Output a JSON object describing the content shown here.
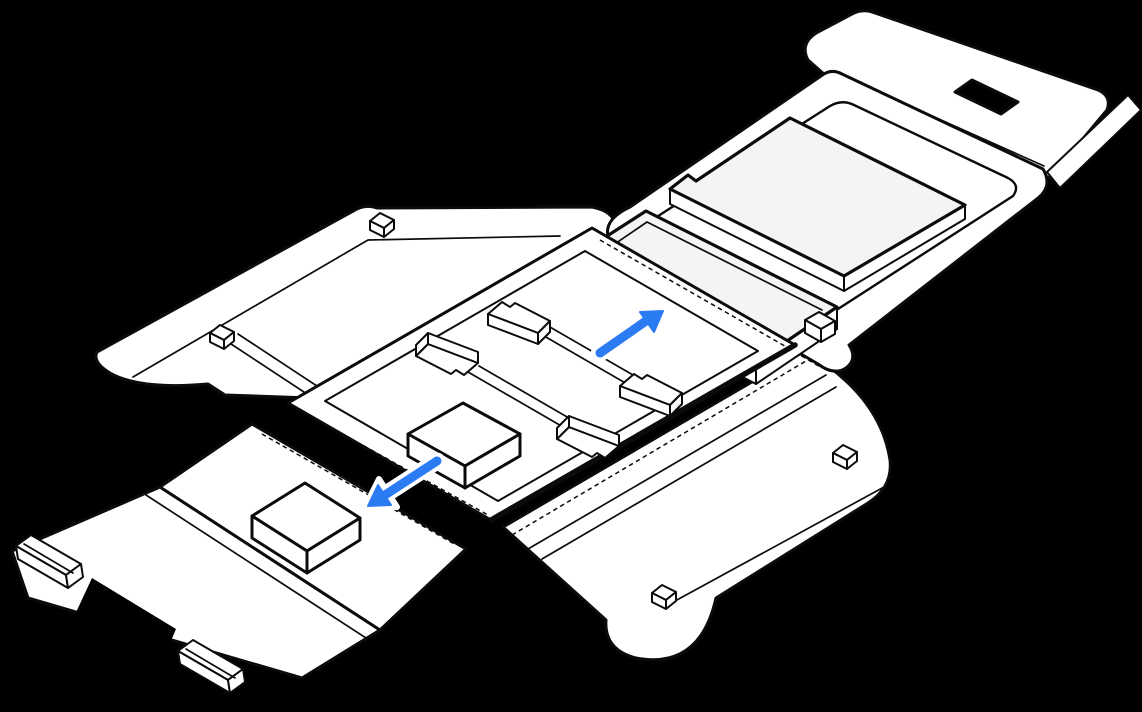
{
  "illustration": {
    "description": "Unfolded laptop shipping box: flattened carton with center packing tray, four corner brackets, inner accessory box, side wing flap with locking tabs, bottom flap holding a small accessory box, and a lid panel with a carry-handle cutout where a wrapped laptop and packing slab sit. A blue arrow points up-right toward the laptop position and a second blue arrow points down-left toward the accessory box.",
    "colors": {
      "background": "#000000",
      "line": "#0b0b0b",
      "paper": "#ffffff",
      "paper_shade": "#f4f4f6",
      "accent": "#2b7bf3",
      "halo": "#ffffff"
    },
    "icons": [
      {
        "name": "arrow-up-right-icon",
        "direction": "up-right",
        "meaning": "place laptop into lid tray"
      },
      {
        "name": "arrow-down-left-icon",
        "direction": "down-left",
        "meaning": "accessory box goes on bottom flap"
      }
    ],
    "parts": [
      "left-wing-flap",
      "locking-tab",
      "bottom-flap",
      "bottom-flap-skirt",
      "hand-hole-notch",
      "carry-rail",
      "accessory-box",
      "side-flap-right",
      "lid-top-flap",
      "handle-cutout",
      "right-edge-flap",
      "box-lid-panel",
      "lid-recess",
      "packing-slab",
      "laptop-sleeve",
      "packing-tray",
      "corner-bracket",
      "inner-accessory-box"
    ]
  }
}
